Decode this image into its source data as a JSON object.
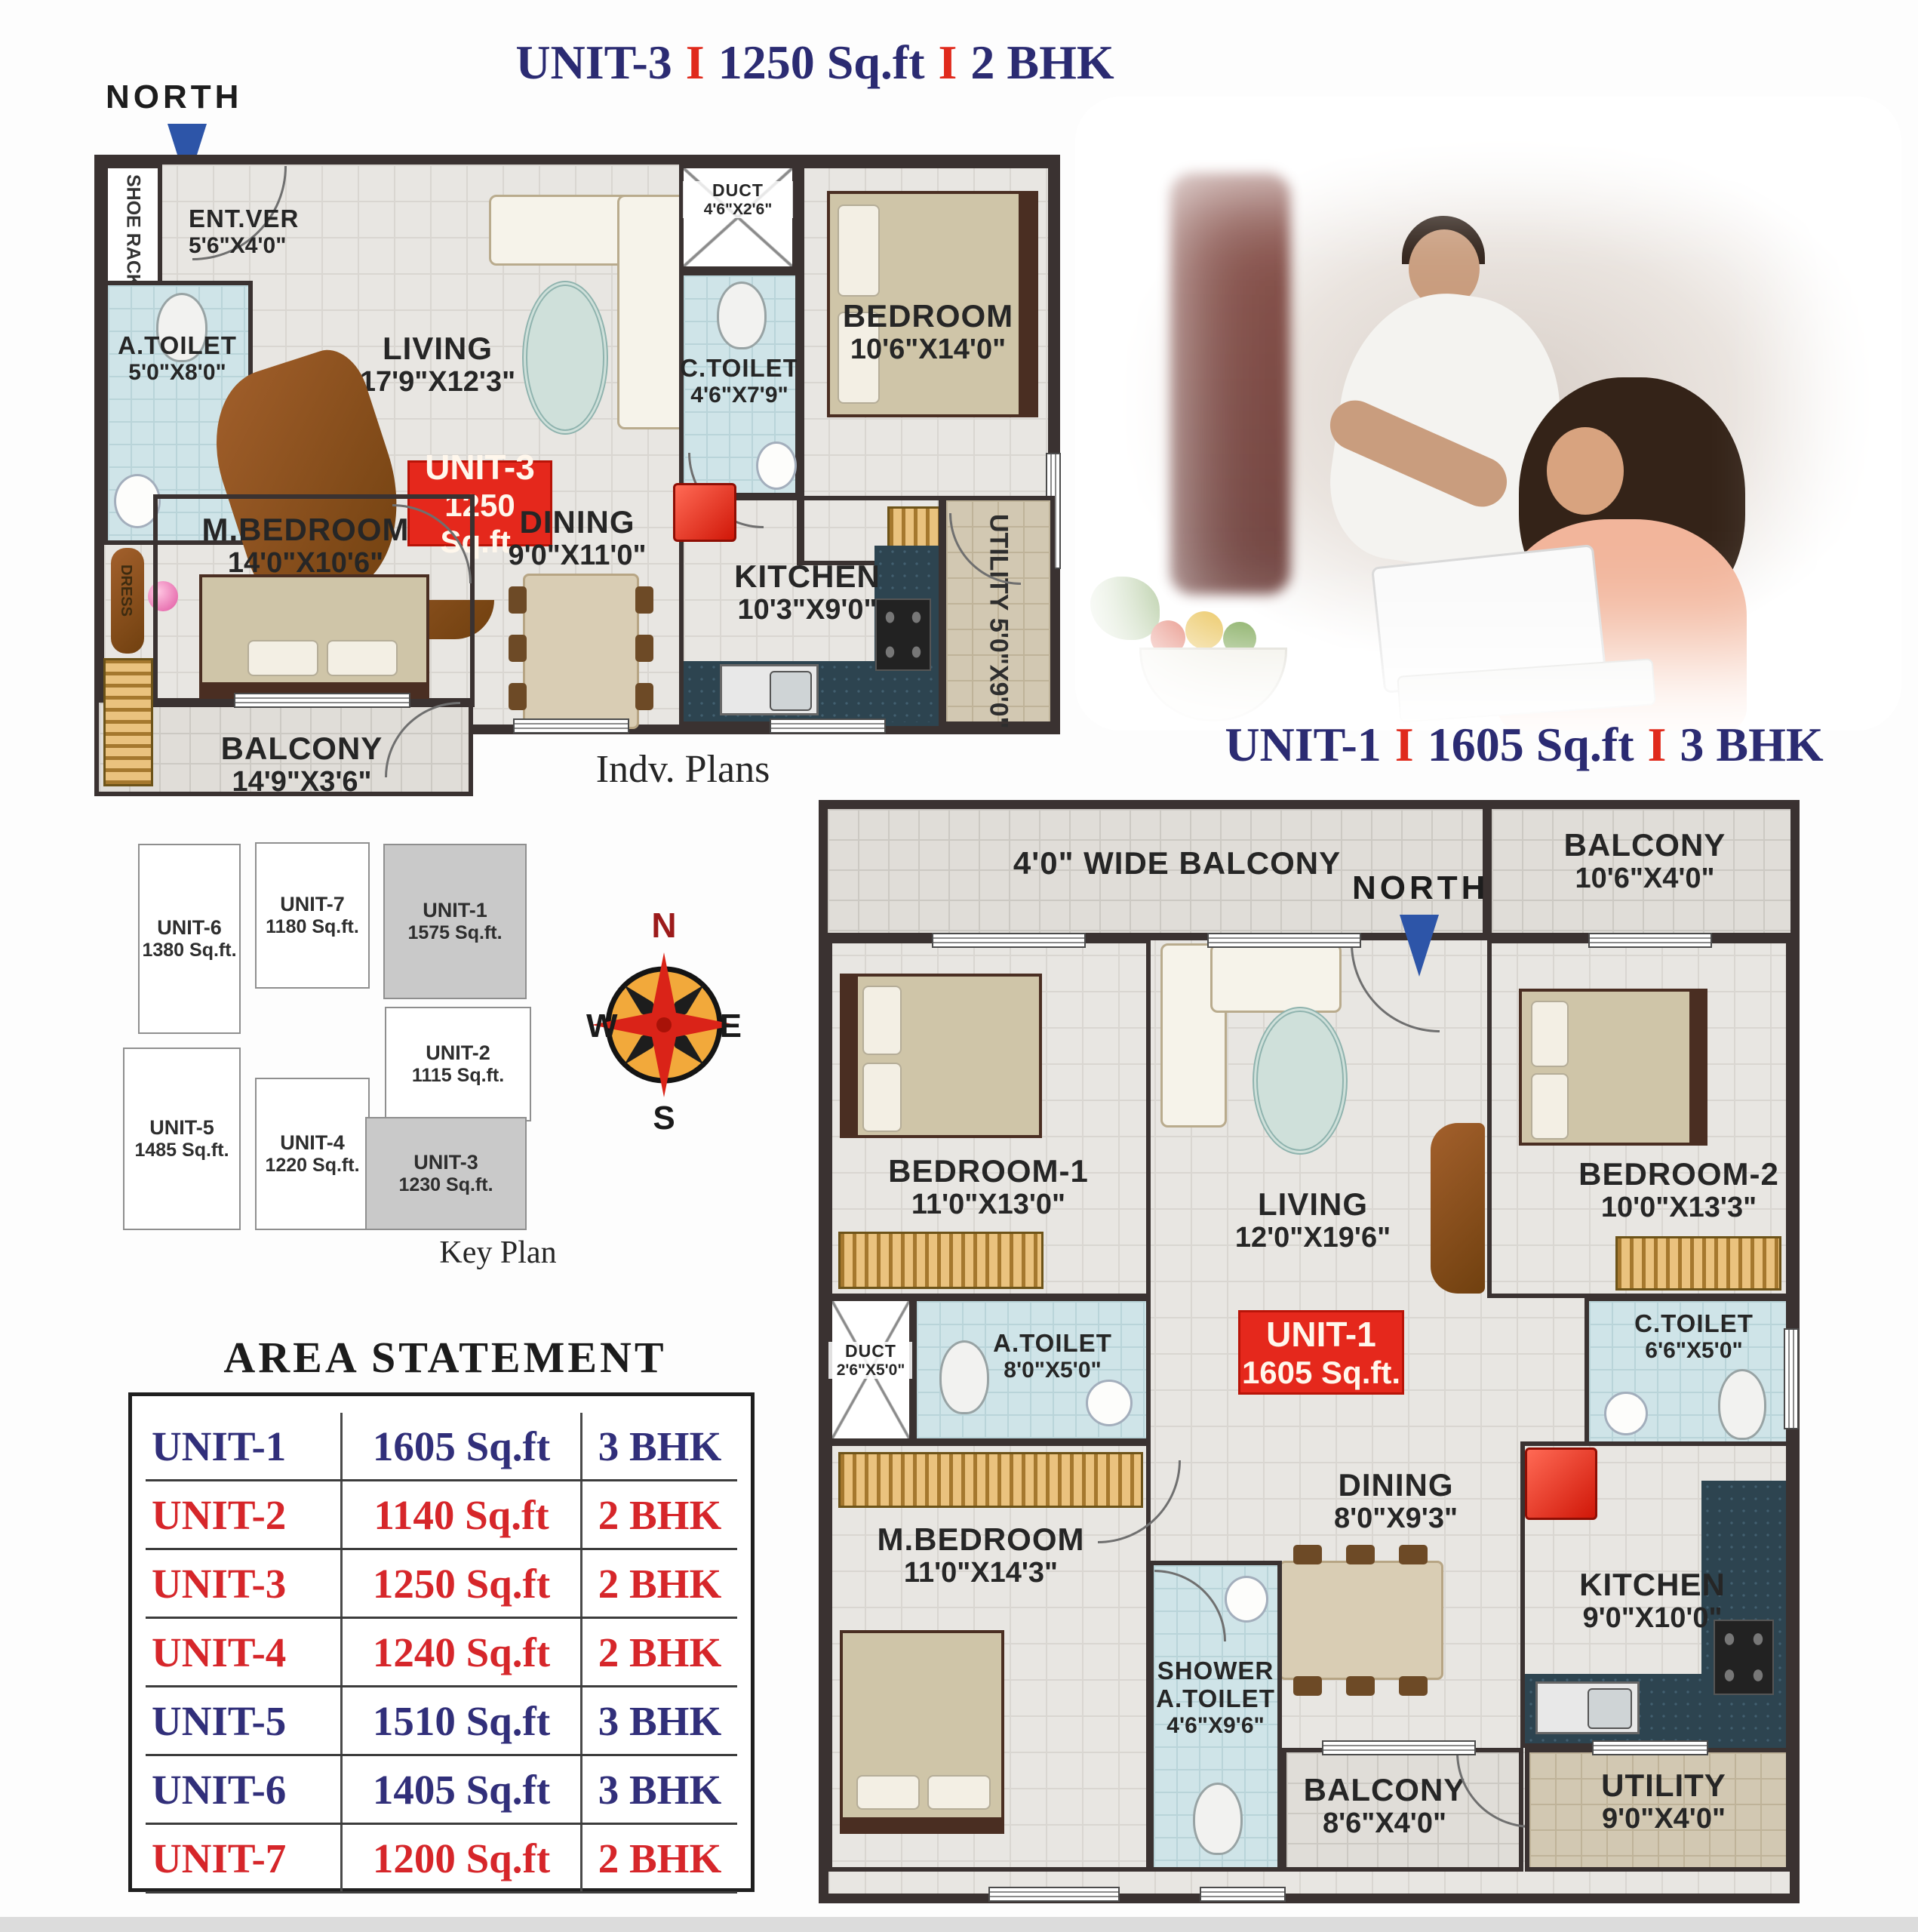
{
  "colors": {
    "title_navy": "#2b2b72",
    "separator_red": "#e02a1c",
    "badge_red": "#e5281c",
    "wall_dark": "#3a3231",
    "toilet_blue": "#cfe4e8",
    "floor_gray": "#e8e6e2",
    "utility_tan": "#d2c8b2",
    "counter_teal": "#2d4450",
    "north_arrow_blue": "#2d55a8",
    "table_navy": "#312f7a",
    "table_red": "#d6262a",
    "keyplan_highlight": "#c9c9c9"
  },
  "unit3": {
    "title": {
      "name": "UNIT-3",
      "sep": "I",
      "area": "1250 Sq.ft",
      "bhk": "2 BHK"
    },
    "north": "NORTH",
    "badge": {
      "line1": "UNIT-3",
      "line2": "1250 Sq.ft."
    },
    "rooms": {
      "shoe_rack": {
        "label": "SHOE RACK"
      },
      "ent_ver": {
        "label": "ENT.VER",
        "dims": "5'6\"X4'0\""
      },
      "living": {
        "label": "LIVING",
        "dims": "17'9\"X12'3\""
      },
      "duct": {
        "label": "DUCT",
        "dims": "4'6\"X2'6\""
      },
      "c_toilet": {
        "label": "C.TOILET",
        "dims": "4'6\"X7'9\""
      },
      "bedroom": {
        "label": "BEDROOM",
        "dims": "10'6\"X14'0\""
      },
      "a_toilet": {
        "label": "A.TOILET",
        "dims": "5'0\"X8'0\""
      },
      "dress": {
        "label": "DRESS"
      },
      "m_bedroom": {
        "label": "M.BEDROOM",
        "dims": "14'0\"X10'6\""
      },
      "dining": {
        "label": "DINING",
        "dims": "9'0\"X11'0\""
      },
      "kitchen": {
        "label": "KITCHEN",
        "dims": "10'3\"X9'0\""
      },
      "utility": {
        "label": "UTILITY",
        "dims": "5'0\"X9'0\""
      },
      "balcony": {
        "label": "BALCONY",
        "dims": "14'9\"X3'6\""
      }
    }
  },
  "indv_plans": "Indv. Plans",
  "key_plan": {
    "caption": "Key Plan",
    "units": [
      {
        "name": "UNIT-6",
        "area": "1380 Sq.ft.",
        "highlighted": false
      },
      {
        "name": "UNIT-7",
        "area": "1180 Sq.ft.",
        "highlighted": false
      },
      {
        "name": "UNIT-1",
        "area": "1575 Sq.ft.",
        "highlighted": true
      },
      {
        "name": "UNIT-2",
        "area": "1115 Sq.ft.",
        "highlighted": false
      },
      {
        "name": "UNIT-5",
        "area": "1485 Sq.ft.",
        "highlighted": false
      },
      {
        "name": "UNIT-4",
        "area": "1220 Sq.ft.",
        "highlighted": false
      },
      {
        "name": "UNIT-3",
        "area": "1230 Sq.ft.",
        "highlighted": true
      }
    ]
  },
  "compass": {
    "n": "N",
    "e": "E",
    "s": "S",
    "w": "W"
  },
  "area_statement": {
    "title": "AREA STATEMENT",
    "rows": [
      {
        "unit": "UNIT-1",
        "area": "1605 Sq.ft",
        "bhk": "3 BHK",
        "color": "navy"
      },
      {
        "unit": "UNIT-2",
        "area": "1140 Sq.ft",
        "bhk": "2 BHK",
        "color": "red"
      },
      {
        "unit": "UNIT-3",
        "area": "1250 Sq.ft",
        "bhk": "2 BHK",
        "color": "red"
      },
      {
        "unit": "UNIT-4",
        "area": "1240 Sq.ft",
        "bhk": "2 BHK",
        "color": "red"
      },
      {
        "unit": "UNIT-5",
        "area": "1510 Sq.ft",
        "bhk": "3 BHK",
        "color": "navy"
      },
      {
        "unit": "UNIT-6",
        "area": "1405 Sq.ft",
        "bhk": "3 BHK",
        "color": "navy"
      },
      {
        "unit": "UNIT-7",
        "area": "1200 Sq.ft",
        "bhk": "2 BHK",
        "color": "red"
      }
    ]
  },
  "unit1": {
    "title": {
      "name": "UNIT-1",
      "sep": "I",
      "area": "1605 Sq.ft",
      "bhk": "3 BHK"
    },
    "north": "NORTH",
    "badge": {
      "line1": "UNIT-1",
      "line2": "1605 Sq.ft."
    },
    "rooms": {
      "wide_balcony": {
        "label": "4'0\" WIDE BALCONY"
      },
      "balcony_top": {
        "label": "BALCONY",
        "dims": "10'6\"X4'0\""
      },
      "bedroom1": {
        "label": "BEDROOM-1",
        "dims": "11'0\"X13'0\""
      },
      "living": {
        "label": "LIVING",
        "dims": "12'0\"X19'6\""
      },
      "bedroom2": {
        "label": "BEDROOM-2",
        "dims": "10'0\"X13'3\""
      },
      "duct": {
        "label": "DUCT",
        "dims": "2'6\"X5'0\""
      },
      "a_toilet": {
        "label": "A.TOILET",
        "dims": "8'0\"X5'0\""
      },
      "c_toilet": {
        "label": "C.TOILET",
        "dims": "6'6\"X5'0\""
      },
      "m_bedroom": {
        "label": "M.BEDROOM",
        "dims": "11'0\"X14'3\""
      },
      "dining": {
        "label": "DINING",
        "dims": "8'0\"X9'3\""
      },
      "kitchen": {
        "label": "KITCHEN",
        "dims": "9'0\"X10'0\""
      },
      "shower": {
        "label": "SHOWER",
        "label2": "A.TOILET",
        "dims": "4'6\"X9'6\""
      },
      "balcony_bottom": {
        "label": "BALCONY",
        "dims": "8'6\"X4'0\""
      },
      "utility": {
        "label": "UTILITY",
        "dims": "9'0\"X4'0\""
      }
    }
  }
}
